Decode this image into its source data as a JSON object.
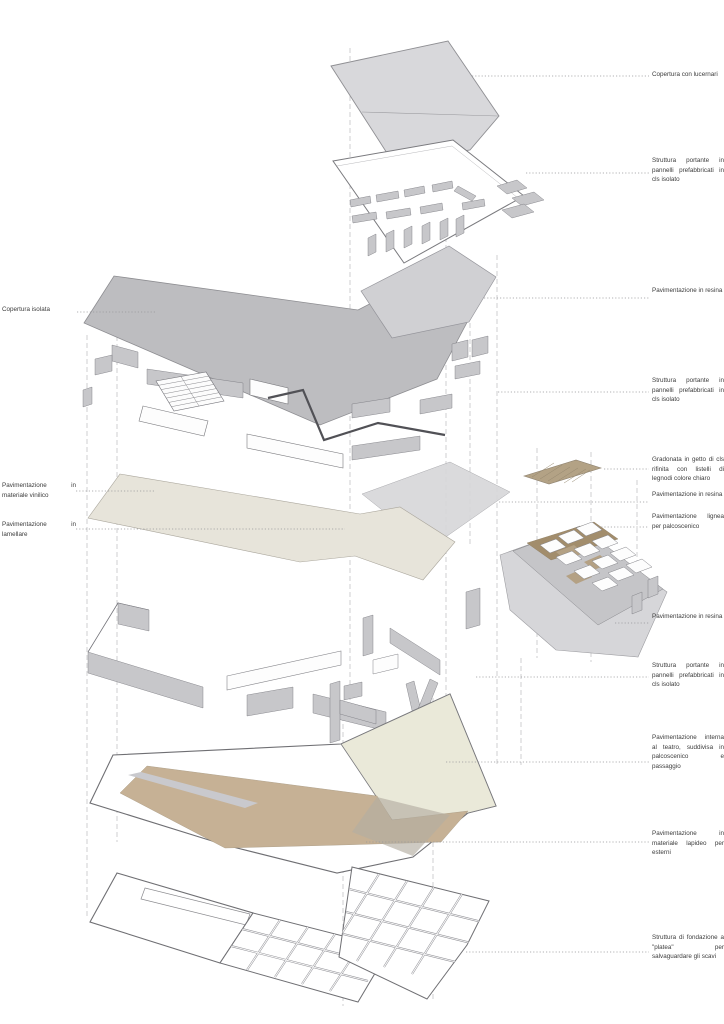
{
  "figure": {
    "type": "exploded axonometric architectural diagram",
    "language": "it",
    "subject": "teatro - stratigrafia costruttiva"
  },
  "labels": {
    "right": [
      "Copertura con lucernari",
      "Struttura portante in pannelli prefabbricati in cls isolato",
      "Pavimentazione in resina",
      "Struttura portante in pannelli prefabbricati in cls isolato",
      "Gradonata in getto di cls rifinita con listelli di legnodi colore chiaro",
      "Pavimentazione in resina",
      "Pavimentazione lignea per palcoscenico",
      "Pavimentazione in resina",
      "Struttura portante in pannelli prefabbricati in cls isolato",
      "Pavimentazione interna al teatro, suddivisa in palcoscenico e passaggio",
      "Pavimentazione in materiale lapideo per esterni",
      "Struttura di fondazione a \"platea\" per salvaguardare gli scavi"
    ],
    "left": [
      "Copertura isolata",
      "Pavimentazione in materiale vinilico",
      "Pavimentazione in lamellare"
    ]
  },
  "colors": {
    "background": "#ffffff",
    "roof_skylights_gray": "#d8d8db",
    "insulated_roof_gray": "#bdbdc0",
    "resin_floor_gray": "#d0d0d3",
    "resin_floor_gray_2": "#d7d7da",
    "vinyl_floor_beige": "#e7e4da",
    "theatre_floor_tan": "#c6b195",
    "stage_floor_cream": "#eae9d9",
    "gradonata_tan": "#b3a285",
    "stage_wood_tan": "#a28d6c",
    "wall_gray": "#c7c7ca",
    "outline_gray": "#7a7a7e",
    "leader_gray": "#98989b",
    "guide_gray": "#c4c4c7",
    "label_text": "#3c3c3c"
  }
}
